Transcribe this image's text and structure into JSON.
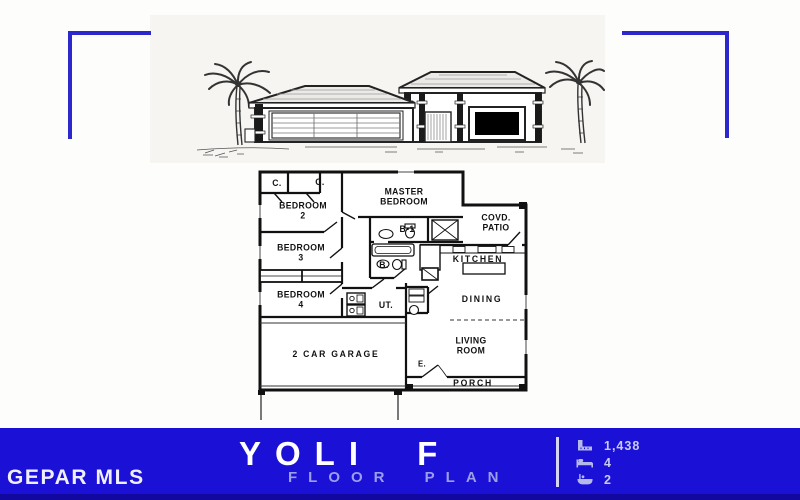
{
  "branding": {
    "mls_label": "GEPAR MLS",
    "plan_name": "YOLI F",
    "plan_subtitle": "FLOOR PLAN"
  },
  "stats": [
    {
      "icon": "sqft-ruler-icon",
      "value": "1,438"
    },
    {
      "icon": "bed-icon",
      "value": "4"
    },
    {
      "icon": "bath-icon",
      "value": "2"
    }
  ],
  "floor_plan": {
    "rooms": [
      {
        "id": "closet-1",
        "label": "C."
      },
      {
        "id": "closet-2",
        "label": "C."
      },
      {
        "id": "bedroom-2",
        "label": "BEDROOM 2"
      },
      {
        "id": "master-bedroom",
        "label": "MASTER BEDROOM"
      },
      {
        "id": "covered-patio",
        "label": "COVD. PATIO"
      },
      {
        "id": "bedroom-3",
        "label": "BEDROOM 3"
      },
      {
        "id": "bath-1",
        "label": "B-1"
      },
      {
        "id": "bath",
        "label": "B."
      },
      {
        "id": "kitchen",
        "label": "KITCHEN"
      },
      {
        "id": "bedroom-4",
        "label": "BEDROOM 4"
      },
      {
        "id": "utility",
        "label": "UT."
      },
      {
        "id": "dining",
        "label": "DINING"
      },
      {
        "id": "garage",
        "label": "2 CAR GARAGE"
      },
      {
        "id": "living-room",
        "label": "LIVING ROOM"
      },
      {
        "id": "entry",
        "label": "E."
      },
      {
        "id": "porch",
        "label": "PORCH"
      }
    ]
  },
  "colors": {
    "banner_blue": "#1b10d6",
    "banner_blue_dark": "#1208a0",
    "bracket_blue": "#2c28cb",
    "subtitle_text": "#9b9fe8",
    "stats_text": "#c9cbf2",
    "drawing_ink": "#1a1a1a"
  }
}
